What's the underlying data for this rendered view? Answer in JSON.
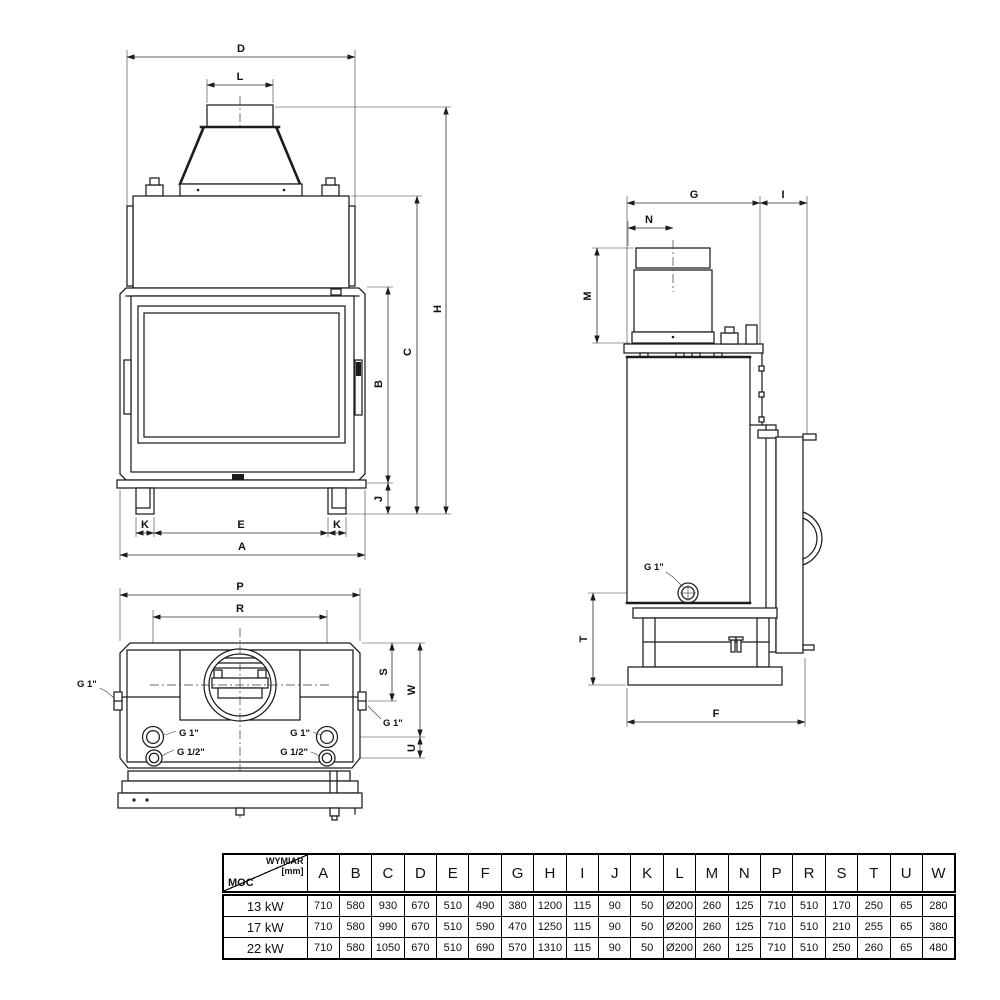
{
  "dims": {
    "A": "A",
    "B": "B",
    "C": "C",
    "D": "D",
    "E": "E",
    "F": "F",
    "G": "G",
    "H": "H",
    "I": "I",
    "J": "J",
    "K": "K",
    "L": "L",
    "M": "M",
    "N": "N",
    "P": "P",
    "R": "R",
    "S": "S",
    "T": "T",
    "U": "U",
    "W": "W"
  },
  "labels": {
    "g1": "G 1\"",
    "g12": "G 1/2\""
  },
  "table": {
    "corner": {
      "line1": "WYMIAR",
      "line2": "[mm]",
      "row_header": "MOC"
    },
    "columns": [
      "A",
      "B",
      "C",
      "D",
      "E",
      "F",
      "G",
      "H",
      "I",
      "J",
      "K",
      "L",
      "M",
      "N",
      "P",
      "R",
      "S",
      "T",
      "U",
      "W"
    ],
    "rows": [
      {
        "power": "13 kW",
        "values": [
          "710",
          "580",
          "930",
          "670",
          "510",
          "490",
          "380",
          "1200",
          "115",
          "90",
          "50",
          "Ø200",
          "260",
          "125",
          "710",
          "510",
          "170",
          "250",
          "65",
          "280"
        ]
      },
      {
        "power": "17 kW",
        "values": [
          "710",
          "580",
          "990",
          "670",
          "510",
          "590",
          "470",
          "1250",
          "115",
          "90",
          "50",
          "Ø200",
          "260",
          "125",
          "710",
          "510",
          "210",
          "255",
          "65",
          "380"
        ]
      },
      {
        "power": "22 kW",
        "values": [
          "710",
          "580",
          "1050",
          "670",
          "510",
          "690",
          "570",
          "1310",
          "115",
          "90",
          "50",
          "Ø200",
          "260",
          "125",
          "710",
          "510",
          "250",
          "260",
          "65",
          "480"
        ]
      }
    ]
  }
}
